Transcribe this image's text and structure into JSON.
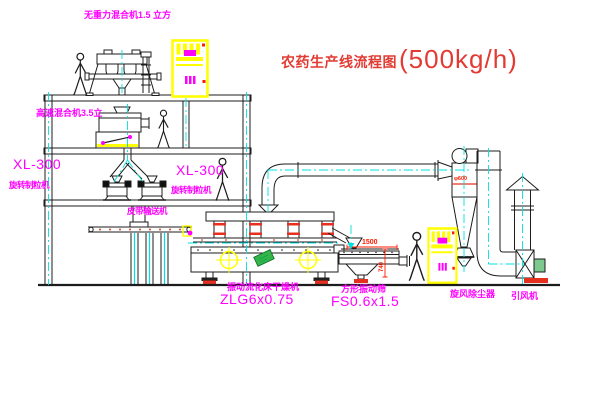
{
  "title": {
    "name": "农药生产线流程图",
    "capacity": "(500kg/h)"
  },
  "labels": {
    "gravity_mixer": "无重力混合机1.5 立方",
    "high_speed_mixer": "高速混合机3.5立",
    "granulator_left_model": "XL-300",
    "granulator_left_name": "旋转制粒机",
    "granulator_right_model": "XL-300",
    "granulator_right_name": "旋转制粒机",
    "belt_conveyor": "皮带输送机",
    "dryer_name": "振动流化床干燥机",
    "dryer_model": "ZLG6x0.75",
    "sieve_name": "方形振动筛",
    "sieve_model": "FS0.6x1.5",
    "cyclone_name": "旋风除尘器",
    "fan_name": "引风机"
  },
  "dimensions": {
    "cyclone_diameter": "φ600",
    "sieve_length": "1500",
    "sieve_height": "740"
  },
  "colors": {
    "label_magenta": "#ff00ff",
    "title_red": "#e23b33",
    "dimension_red": "#ff1a00",
    "centerline_cyan": "#00e0e0",
    "cabinet_yellow": "#ffff00",
    "line_black": "#1c1c1c",
    "nameplate_green": "#35b44a"
  }
}
